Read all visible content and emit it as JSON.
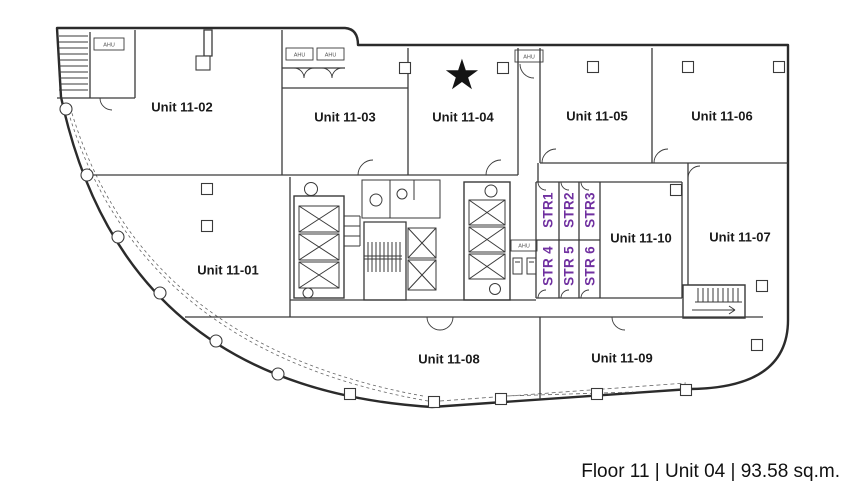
{
  "caption": "Floor 11 | Unit 04 | 93.58 sq.m.",
  "star_glyph": "★",
  "units": [
    {
      "label": "Unit 11-01"
    },
    {
      "label": "Unit 11-02"
    },
    {
      "label": "Unit 11-03"
    },
    {
      "label": "Unit 11-04"
    },
    {
      "label": "Unit 11-05"
    },
    {
      "label": "Unit 11-06"
    },
    {
      "label": "Unit 11-07"
    },
    {
      "label": "Unit 11-08"
    },
    {
      "label": "Unit 11-09"
    },
    {
      "label": "Unit 11-10"
    }
  ],
  "str_rooms": [
    {
      "label": "STR1"
    },
    {
      "label": "STR2"
    },
    {
      "label": "STR3"
    },
    {
      "label": "STR 4"
    },
    {
      "label": "STR 5"
    },
    {
      "label": "STR 6"
    }
  ],
  "equipment": {
    "ahu_label": "AHU"
  },
  "colors": {
    "str_text": "#7030A0",
    "walls": "#3a3a3a",
    "outer_wall": "#2b2b2b",
    "label_text": "#1a1a1a"
  }
}
